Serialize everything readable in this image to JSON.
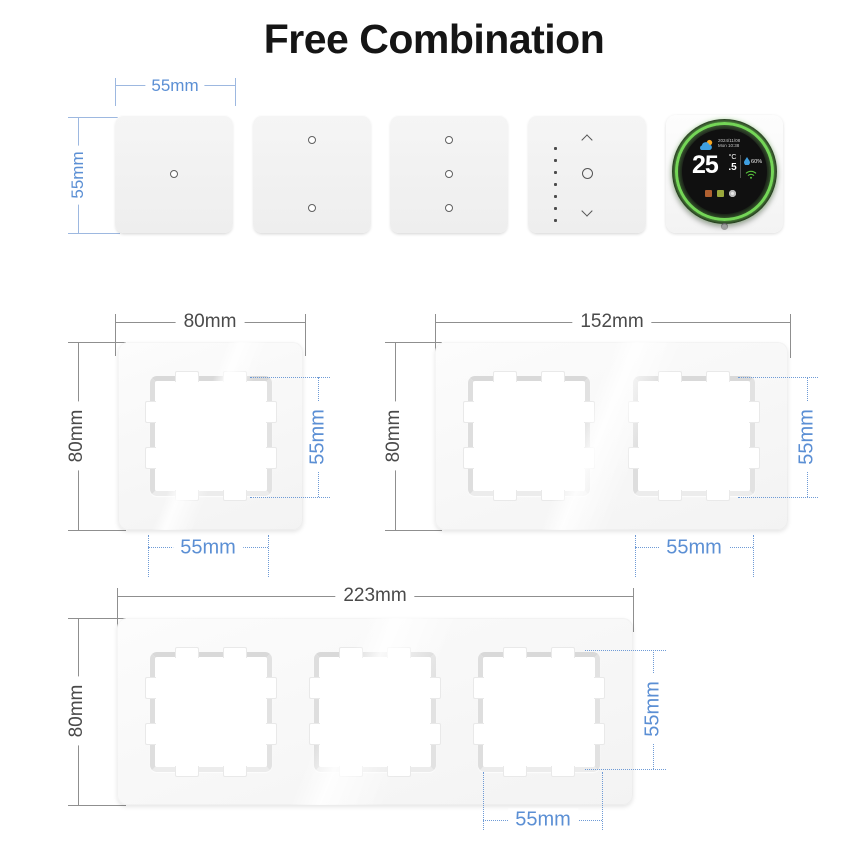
{
  "title": "Free Combination",
  "colors": {
    "dim_blue": "#5b8fd4",
    "dim_gray": "#4a4a4a",
    "ring_green": "#74d657",
    "panel_white": "#f4f4f4"
  },
  "module_row": {
    "width_label": "55mm",
    "height_label": "55mm",
    "modules": [
      {
        "type": "touch-switch",
        "dots": 1
      },
      {
        "type": "touch-switch",
        "dots": 2
      },
      {
        "type": "touch-switch",
        "dots": 3
      },
      {
        "type": "dimmer-switch",
        "dots": 0
      },
      {
        "type": "thermostat",
        "dots": 0
      }
    ]
  },
  "thermostat": {
    "date": "2024/11/08",
    "time": "Mon 10:38",
    "temp_int": "25",
    "temp_unit": "°C",
    "temp_frac": ".5",
    "humidity": "60%"
  },
  "frames": [
    {
      "name": "single-frame",
      "gangs": 1,
      "width_label": "80mm",
      "height_label": "80mm",
      "opening_width_label": "55mm",
      "opening_height_label": "55mm"
    },
    {
      "name": "double-frame",
      "gangs": 2,
      "width_label": "152mm",
      "height_label": "80mm",
      "opening_width_label": "55mm",
      "opening_height_label": "55mm"
    },
    {
      "name": "triple-frame",
      "gangs": 3,
      "width_label": "223mm",
      "height_label": "80mm",
      "opening_width_label": "55mm",
      "opening_height_label": "55mm"
    }
  ]
}
